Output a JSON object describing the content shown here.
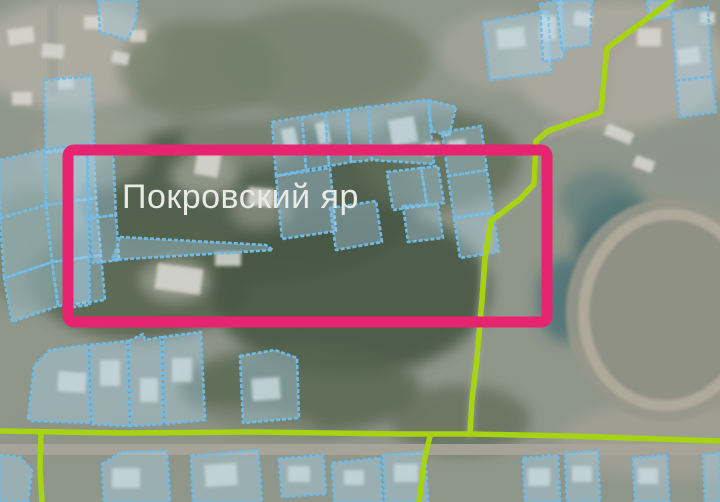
{
  "app": {
    "type": "cadastral-satellite-map",
    "label": {
      "text": "Покровский яр",
      "x": 122,
      "y": 208,
      "font_size": 34,
      "color": "#e9e9e6"
    },
    "colors": {
      "base": "#8f968a",
      "parcel_stroke": "#70bbe6",
      "parcel_fill": "rgba(173,215,241,0.38)",
      "route": "#a6d312",
      "road": "#a8a49a",
      "highlight": "#e62470",
      "house": "#d9d9d1"
    },
    "highlight_rect": {
      "x": 68,
      "y": 150,
      "width": 479,
      "height": 172,
      "stroke_width": 11,
      "corner_radius": 6
    },
    "stadium": {
      "cx": 668,
      "cy": 310,
      "rx": 102,
      "ry": 112,
      "ring_rx": 84,
      "ring_ry": 96,
      "rotation": 8,
      "base_fill": "#97978a",
      "infield_fill": "#8f9184",
      "ring_color": "#b2ac9d",
      "ring_width": 11
    },
    "background_blobs": [
      {
        "cx": 70,
        "cy": 55,
        "rx": 95,
        "ry": 55,
        "fill": "#b2afa5",
        "op": 0.85
      },
      {
        "cx": 200,
        "cy": 70,
        "rx": 80,
        "ry": 50,
        "fill": "#6e7a64",
        "op": 0.7
      },
      {
        "cx": 320,
        "cy": 60,
        "rx": 110,
        "ry": 55,
        "fill": "#72806a",
        "op": 0.75
      },
      {
        "cx": 250,
        "cy": 200,
        "rx": 170,
        "ry": 80,
        "fill": "#4d5c48",
        "op": 0.9
      },
      {
        "cx": 140,
        "cy": 280,
        "rx": 110,
        "ry": 60,
        "fill": "#55644e",
        "op": 0.85
      },
      {
        "cx": 350,
        "cy": 290,
        "rx": 140,
        "ry": 85,
        "fill": "#4a5945",
        "op": 0.9
      },
      {
        "cx": 440,
        "cy": 160,
        "rx": 80,
        "ry": 50,
        "fill": "#5e6d56",
        "op": 0.8
      },
      {
        "cx": 300,
        "cy": 390,
        "rx": 120,
        "ry": 45,
        "fill": "#57664f",
        "op": 0.8
      },
      {
        "cx": 460,
        "cy": 420,
        "rx": 70,
        "ry": 35,
        "fill": "#5e6b55",
        "op": 0.7
      },
      {
        "cx": 620,
        "cy": 65,
        "rx": 110,
        "ry": 65,
        "fill": "#b0ada3",
        "op": 0.8
      },
      {
        "cx": 500,
        "cy": 50,
        "rx": 60,
        "ry": 40,
        "fill": "#a8a79c",
        "op": 0.7
      },
      {
        "cx": 620,
        "cy": 250,
        "rx": 45,
        "ry": 55,
        "fill": "#43686c",
        "op": 0.85
      },
      {
        "cx": 565,
        "cy": 300,
        "rx": 28,
        "ry": 42,
        "fill": "#4a7076",
        "op": 0.8
      },
      {
        "cx": 600,
        "cy": 200,
        "rx": 40,
        "ry": 30,
        "fill": "#567a78",
        "op": 0.6
      },
      {
        "cx": 670,
        "cy": 440,
        "rx": 110,
        "ry": 40,
        "fill": "#a3a095",
        "op": 0.8
      },
      {
        "cx": 90,
        "cy": 150,
        "rx": 60,
        "ry": 40,
        "fill": "#9aa091",
        "op": 0.6
      },
      {
        "cx": 30,
        "cy": 250,
        "rx": 50,
        "ry": 60,
        "fill": "#6b7a62",
        "op": 0.6
      },
      {
        "cx": 170,
        "cy": 430,
        "rx": 150,
        "ry": 25,
        "fill": "#8d9383",
        "op": 0.6
      },
      {
        "cx": 690,
        "cy": 160,
        "rx": 50,
        "ry": 40,
        "fill": "#8f948a",
        "op": 0.6
      },
      {
        "cx": 240,
        "cy": 140,
        "rx": 60,
        "ry": 30,
        "fill": "#9aa295",
        "op": 0.5
      },
      {
        "cx": 205,
        "cy": 175,
        "rx": 35,
        "ry": 22,
        "fill": "#b5b8ac",
        "op": 0.6
      },
      {
        "cx": 260,
        "cy": 210,
        "rx": 30,
        "ry": 20,
        "fill": "#a9aca0",
        "op": 0.5
      },
      {
        "cx": 175,
        "cy": 280,
        "rx": 35,
        "ry": 22,
        "fill": "#b0b0a4",
        "op": 0.65
      }
    ],
    "roads": [
      {
        "points": "0,447 360,449 720,452",
        "width": 22,
        "color": "#a8a49a",
        "op": 0.95
      },
      {
        "points": "676,2 644,26 610,50 606,80 603,112 550,131",
        "width": 13,
        "color": "#a5a29a",
        "op": 0.9
      },
      {
        "points": "534,184 520,199 491,221 485,258 482,300 477,358 472,400 470,434",
        "width": 8,
        "color": "#9da295",
        "op": 0.7
      },
      {
        "points": "50,0 52,48 55,90",
        "width": 16,
        "color": "#a0a39a",
        "op": 0.8
      }
    ],
    "houses": [
      {
        "x": 8,
        "y": 28,
        "w": 26,
        "h": 16,
        "r": -8
      },
      {
        "x": 42,
        "y": 44,
        "w": 22,
        "h": 14,
        "r": 4
      },
      {
        "x": 84,
        "y": 16,
        "w": 18,
        "h": 13,
        "r": 0
      },
      {
        "x": 112,
        "y": 52,
        "w": 17,
        "h": 12,
        "r": 12
      },
      {
        "x": 12,
        "y": 92,
        "w": 20,
        "h": 13,
        "r": 0
      },
      {
        "x": 58,
        "y": 78,
        "w": 16,
        "h": 11,
        "r": -6
      },
      {
        "x": 130,
        "y": 30,
        "w": 16,
        "h": 12,
        "r": 0
      },
      {
        "x": 196,
        "y": 148,
        "w": 24,
        "h": 28,
        "r": 10
      },
      {
        "x": 248,
        "y": 188,
        "w": 26,
        "h": 18,
        "r": 6
      },
      {
        "x": 156,
        "y": 266,
        "w": 46,
        "h": 26,
        "r": 8
      },
      {
        "x": 215,
        "y": 252,
        "w": 26,
        "h": 14,
        "r": 0
      },
      {
        "x": 283,
        "y": 128,
        "w": 14,
        "h": 24,
        "r": -12
      },
      {
        "x": 317,
        "y": 122,
        "w": 12,
        "h": 22,
        "r": -12
      },
      {
        "x": 390,
        "y": 118,
        "w": 26,
        "h": 26,
        "r": -10
      },
      {
        "x": 424,
        "y": 142,
        "w": 17,
        "h": 13,
        "r": -10
      },
      {
        "x": 448,
        "y": 140,
        "w": 18,
        "h": 13,
        "r": -8
      },
      {
        "x": 497,
        "y": 28,
        "w": 28,
        "h": 20,
        "r": -6
      },
      {
        "x": 540,
        "y": 16,
        "w": 16,
        "h": 24,
        "r": 0
      },
      {
        "x": 574,
        "y": 12,
        "w": 18,
        "h": 14,
        "r": 8
      },
      {
        "x": 637,
        "y": 28,
        "w": 24,
        "h": 18,
        "r": 0
      },
      {
        "x": 678,
        "y": 48,
        "w": 22,
        "h": 16,
        "r": -8
      },
      {
        "x": 700,
        "y": 12,
        "w": 15,
        "h": 12,
        "r": 0
      },
      {
        "x": 605,
        "y": 128,
        "w": 28,
        "h": 12,
        "r": 22
      },
      {
        "x": 634,
        "y": 158,
        "w": 20,
        "h": 12,
        "r": 20
      },
      {
        "x": 58,
        "y": 372,
        "w": 28,
        "h": 20,
        "r": 4
      },
      {
        "x": 100,
        "y": 360,
        "w": 20,
        "h": 26,
        "r": 0
      },
      {
        "x": 140,
        "y": 378,
        "w": 18,
        "h": 24,
        "r": 0
      },
      {
        "x": 172,
        "y": 358,
        "w": 20,
        "h": 24,
        "r": 0
      },
      {
        "x": 252,
        "y": 378,
        "w": 28,
        "h": 22,
        "r": -4
      },
      {
        "x": 112,
        "y": 468,
        "w": 28,
        "h": 20,
        "r": 0
      },
      {
        "x": 205,
        "y": 464,
        "w": 32,
        "h": 22,
        "r": -4
      },
      {
        "x": 288,
        "y": 466,
        "w": 22,
        "h": 16,
        "r": 0
      },
      {
        "x": 344,
        "y": 470,
        "w": 20,
        "h": 15,
        "r": 0
      },
      {
        "x": 394,
        "y": 464,
        "w": 24,
        "h": 18,
        "r": 0
      },
      {
        "x": 528,
        "y": 468,
        "w": 22,
        "h": 18,
        "r": 0
      },
      {
        "x": 572,
        "y": 466,
        "w": 20,
        "h": 16,
        "r": 0
      },
      {
        "x": 638,
        "y": 468,
        "w": 20,
        "h": 16,
        "r": 0
      }
    ],
    "parcels": [
      "98,0 137,0 136,22 127,40 100,32",
      "44,80 92,76 94,148 46,153",
      "0,160 44,150 46,205 0,218",
      "44,150 93,143 96,198 46,205",
      "0,218 46,205 52,262 4,278",
      "46,205 96,198 101,255 52,262",
      "4,278 52,262 58,306 12,322",
      "52,262 101,255 105,300 58,306",
      "70,152 87,150 90,305 73,307",
      "87,150 113,148 116,215 90,218",
      "90,218 116,215 119,260 93,263",
      "120,237 266,245 273,250 112,260",
      "272,122 302,117 306,170 276,176",
      "302,117 325,113 329,166 306,170",
      "325,113 347,110 351,162 329,166",
      "347,110 368,107 372,160 351,162",
      "368,107 428,100 434,164 372,160",
      "428,100 456,107 449,136 432,131",
      "276,176 330,168 336,231 282,239",
      "330,208 376,201 382,242 336,250",
      "387,172 421,168 427,205 393,210",
      "421,168 438,166 444,203 427,205",
      "403,206 438,204 443,238 408,242",
      "442,132 481,126 487,170 448,176",
      "448,176 487,170 493,212 454,218",
      "454,218 493,212 499,252 460,258",
      "483,22 548,11 552,72 490,80",
      "540,4 562,0 564,58 543,62",
      "556,0 592,0 590,45 562,49",
      "647,0 673,0 671,17 649,19",
      "672,12 708,7 712,76 676,81",
      "676,81 712,76 716,112 680,117",
      "28,418 34,366 50,350 88,345 90,423 32,421",
      "90,345 127,341 129,426 92,424",
      "129,341 143,334 145,340 161,337 163,424 131,426",
      "163,337 201,332 205,420 165,424",
      "240,356 275,350 297,358 299,418 243,423",
      "0,455 20,457 32,470 28,502 0,502",
      "102,464 122,452 167,451 170,502 104,502",
      "191,456 258,450 262,502 193,502",
      "279,459 323,455 326,494 282,497",
      "332,463 380,458 382,502 334,502",
      "383,455 425,452 428,502 385,502",
      "523,458 558,455 560,502 525,502",
      "565,453 598,451 600,502 567,502",
      "633,458 667,455 669,502 635,502",
      "703,455 720,453 720,502 705,502"
    ],
    "routes": [
      "672,0 640,24 607,48 604,78 601,112 548,131 536,141 534,184 520,199 491,221 485,258 482,300 477,358 472,400 470,434",
      "0,431 120,433 250,432 400,434 470,434 570,436 660,439 720,441",
      "430,436 424,462 419,502",
      "41,434 40,468 42,502"
    ]
  }
}
